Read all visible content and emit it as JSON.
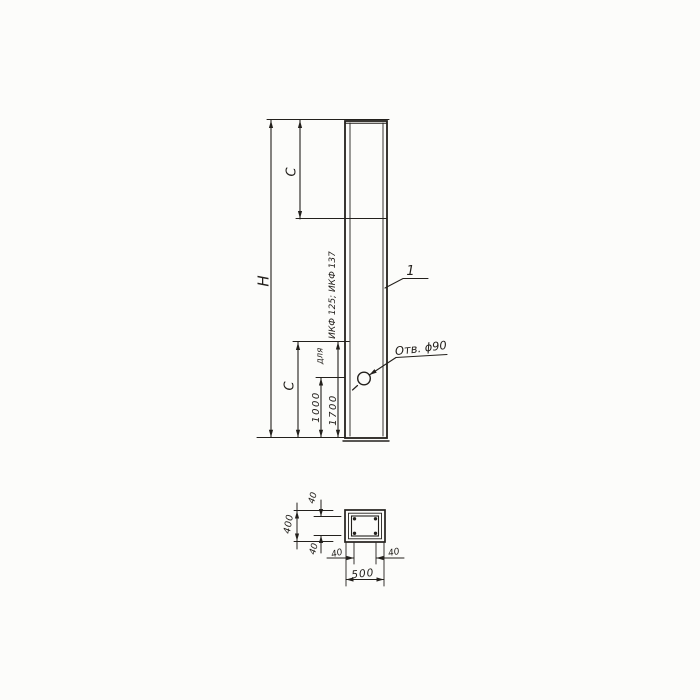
{
  "colors": {
    "ink": "#23201c",
    "paper": "#fcfcfa"
  },
  "elevation": {
    "dim_height_label": "H",
    "dim_c_top_label": "C",
    "dim_c_bottom_label": "C",
    "dim_hole_offset_label": "1000",
    "dim_c_value_label": "1700",
    "note_prefix": "для",
    "note_series": "ИКФ 125; ИКФ 137",
    "hole_callout": "Отв. ϕ90",
    "item_mark": "1"
  },
  "section": {
    "dim_cover_top": "40",
    "dim_height": "400",
    "dim_cover_bottom": "40",
    "dim_cover_left": "40",
    "dim_cover_right": "40",
    "dim_width": "500"
  }
}
